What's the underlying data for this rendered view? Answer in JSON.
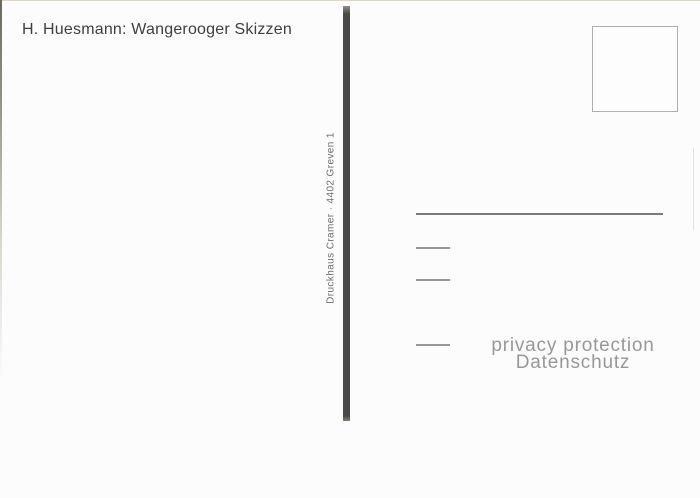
{
  "card": {
    "title": "H. Huesmann: Wangerooger Skizzen",
    "printer_imprint": "Druckhaus Cramer · 4402 Greven 1",
    "watermark": {
      "line1": "privacy protection",
      "line2": "Datenschutz"
    },
    "colors": {
      "card_background": "#fcfcfc",
      "title_text": "#3f3f3f",
      "divider_bar": "#4b4947",
      "imprint_text": "#6e6e6e",
      "stamp_box_border": "#aeaeae",
      "address_line_long": "#7a7a7a",
      "address_line_short": "#979797",
      "watermark_text": "#989898"
    }
  }
}
